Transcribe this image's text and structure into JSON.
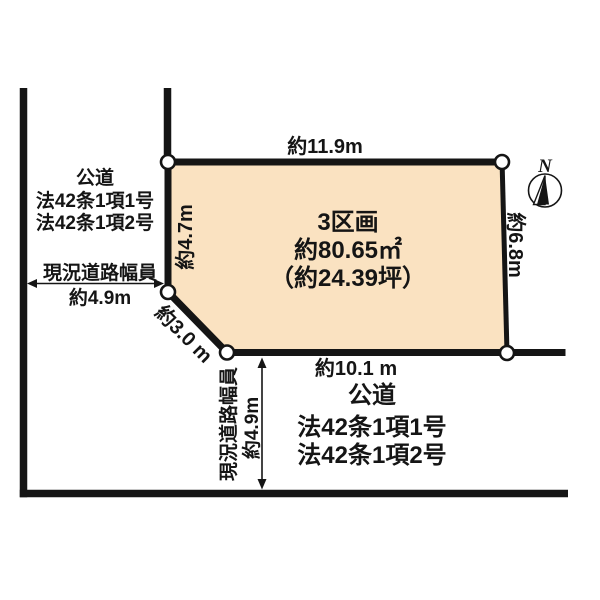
{
  "colors": {
    "plot_fill": "#FAE2C1",
    "line": "#151515",
    "text": "#151515",
    "background": "#FFFFFF"
  },
  "plot": {
    "name": "3区画",
    "area_m2": "約80.65㎡",
    "area_tsubo": "（約24.39坪）",
    "dim_top": "約11.9m",
    "dim_left": "約4.7m",
    "dim_diagonal": "約3.0 m",
    "dim_bottom": "約10.1 m",
    "dim_right": "約6.8m"
  },
  "road_left": {
    "type": "公道",
    "law_line1": "法42条1項1号",
    "law_line2": "法42条1項2号",
    "width_label": "現況道路幅員",
    "width_value": "約4.9m"
  },
  "road_bottom": {
    "type": "公道",
    "law_line1": "法42条1項1号",
    "law_line2": "法42条1項2号",
    "width_label": "現況道路幅員",
    "width_value": "約4.9m"
  },
  "compass": {
    "north_label": "N"
  }
}
